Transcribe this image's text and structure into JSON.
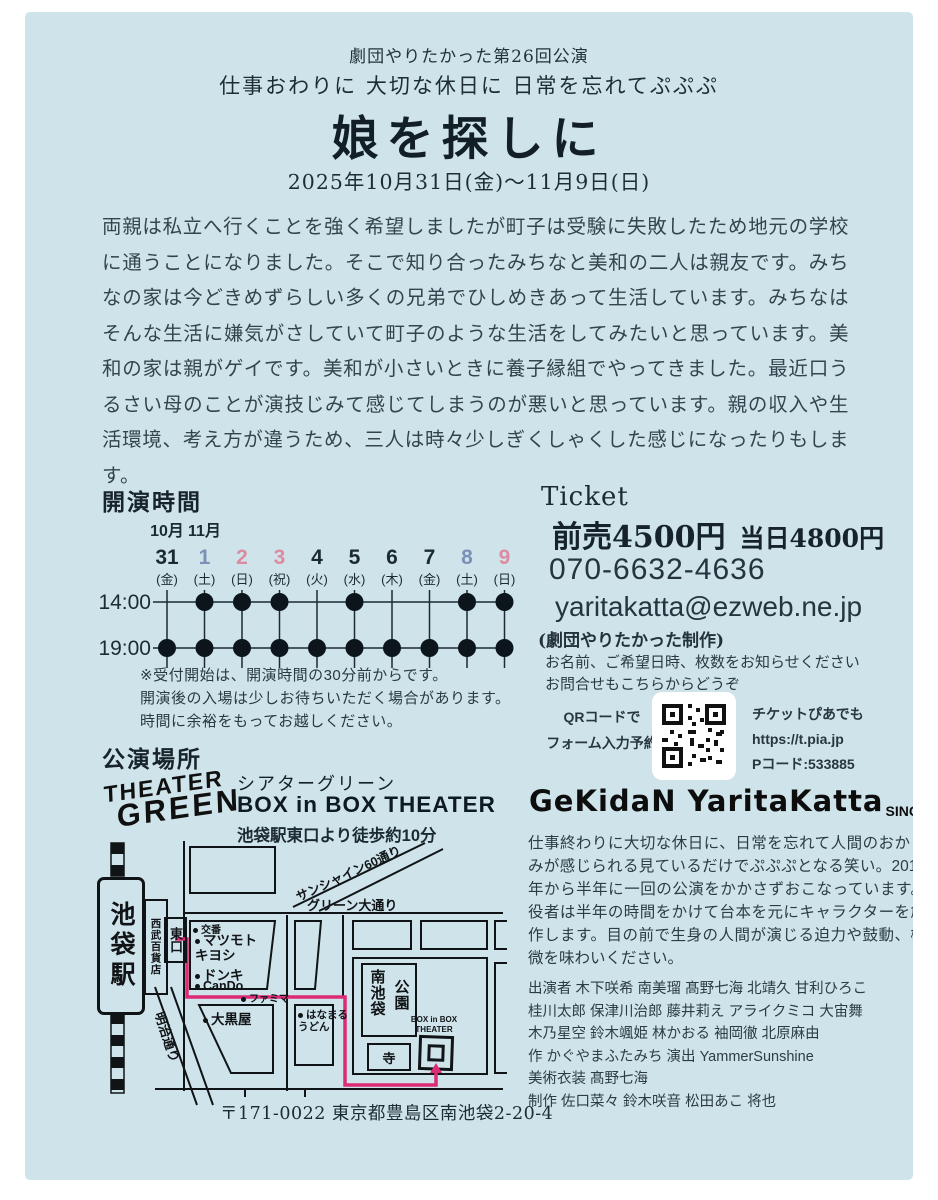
{
  "header": {
    "production": "劇団やりたかった第26回公演",
    "tagline": "仕事おわりに 大切な休日に 日常を忘れてぷぷぷ",
    "title": "娘を探しに",
    "dates": "2025年10月31日(金)〜11月9日(日)"
  },
  "synopsis": "両親は私立へ行くことを強く希望しましたが町子は受験に失敗したため地元の学校に通うことになりました。そこで知り合ったみちなと美和の二人は親友です。みちなの家は今どきめずらしい多くの兄弟でひしめきあって生活しています。みちなはそんな生活に嫌気がさしていて町子のような生活をしてみたいと思っています。美和の家は親がゲイです。美和が小さいときに養子縁組でやってきました。最近口うるさい母のことが演技じみて感じてしまうのが悪いと思っています。親の収入や生活環境、考え方が違うため、三人は時々少しぎくしゃくした感じになったりもします。",
  "schedule": {
    "heading": "開演時間",
    "month_labels": [
      "10月",
      "11月"
    ],
    "time_labels": [
      "14:00",
      "19:00"
    ],
    "days": [
      {
        "num": "31",
        "dow": "(金)",
        "color": "black",
        "t14": false,
        "t19": true
      },
      {
        "num": "1",
        "dow": "(土)",
        "color": "sat",
        "t14": true,
        "t19": true
      },
      {
        "num": "2",
        "dow": "(日)",
        "color": "sun",
        "t14": true,
        "t19": true
      },
      {
        "num": "3",
        "dow": "(祝)",
        "color": "sun",
        "t14": true,
        "t19": true
      },
      {
        "num": "4",
        "dow": "(火)",
        "color": "black",
        "t14": false,
        "t19": true
      },
      {
        "num": "5",
        "dow": "(水)",
        "color": "black",
        "t14": true,
        "t19": true
      },
      {
        "num": "6",
        "dow": "(木)",
        "color": "black",
        "t14": false,
        "t19": true
      },
      {
        "num": "7",
        "dow": "(金)",
        "color": "black",
        "t14": false,
        "t19": true
      },
      {
        "num": "8",
        "dow": "(土)",
        "color": "sat",
        "t14": true,
        "t19": true
      },
      {
        "num": "9",
        "dow": "(日)",
        "color": "sun",
        "t14": true,
        "t19": true
      }
    ],
    "notes": [
      "※受付開始は、開演時間の30分前からです。",
      "開演後の入場は少しお待ちいただく場合があります。",
      "時間に余裕をもってお越しください。"
    ]
  },
  "ticket": {
    "heading": "Ticket",
    "advance": "前売4500円",
    "door": "当日4800円",
    "phone": "070-6632-4636",
    "email": "yaritakatta@ezweb.ne.jp",
    "produced_by": "(劇団やりたかった制作)",
    "instructions": [
      "お名前、ご希望日時、枚数をお知らせください",
      "お問合せもこちらからどうぞ"
    ],
    "qr_left": [
      "QRコードで",
      "フォーム入力予約"
    ],
    "qr_right": [
      "チケットぴあでも",
      "https://t.pia.jp",
      "Pコード:533885"
    ]
  },
  "venue": {
    "heading": "公演場所",
    "logo_line1": "THEATER",
    "logo_line2": "GREEN",
    "name_jp": "シアターグリーン",
    "name_en": "BOX in BOX THEATER",
    "access": "池袋駅東口より徒歩約10分",
    "address": "〒171-0022 東京都豊島区南池袋2-20-4",
    "map": {
      "station": "池袋駅",
      "seibu": "西武百貨店",
      "east_exit": "東口",
      "sunshine": "サンシャイン60通り",
      "green_ave": "グリーン大通り",
      "meiji": "明治通り",
      "koban": "交番",
      "matsumoto": "マツモト\nキヨシ",
      "donki": "ドンキ",
      "cando": "CanDo",
      "famima": "ファミマ",
      "daikokuya": "大黒屋",
      "hanamaru": "はなまる\nうどん",
      "park_right": "南池袋",
      "park_left": "公園",
      "tera": "寺",
      "theater_label": "BOX in BOX\nTHEATER"
    }
  },
  "company": {
    "logo": "GeKidaN YaritaKatta",
    "since": "SINCE2013",
    "about": "仕事終わりに大切な休日に、日常を忘れて人間のおかしみが感じられる見ているだけでぷぷぷとなる笑い。2013年から半年に一回の公演をかかさずおこなっています。役者は半年の時間をかけて台本を元にキャラクターを創作します。目の前で生身の人間が演じる迫力や鼓動、機微を味わいください。",
    "credits": [
      "出演者 木下咲希 南美瑠 髙野七海 北靖久 甘利ひろこ",
      "桂川太郎 保津川治郎 藤井莉え アライクミコ 大宙舞",
      "木乃星空 鈴木颯姫 林かおる 袖岡徹 北原麻由",
      "作 かぐやまふたみち  演出 YammerSunshine",
      "美術衣装 髙野七海",
      "制作 佐口菜々 鈴木咲音 松田あこ 将也"
    ]
  },
  "colors": {
    "background": "#cfe4ea",
    "ink": "#101417",
    "route_pink": "#dd2a74",
    "saturday_blue": "#7b90b6",
    "sunday_pink": "#dc8ba0"
  }
}
